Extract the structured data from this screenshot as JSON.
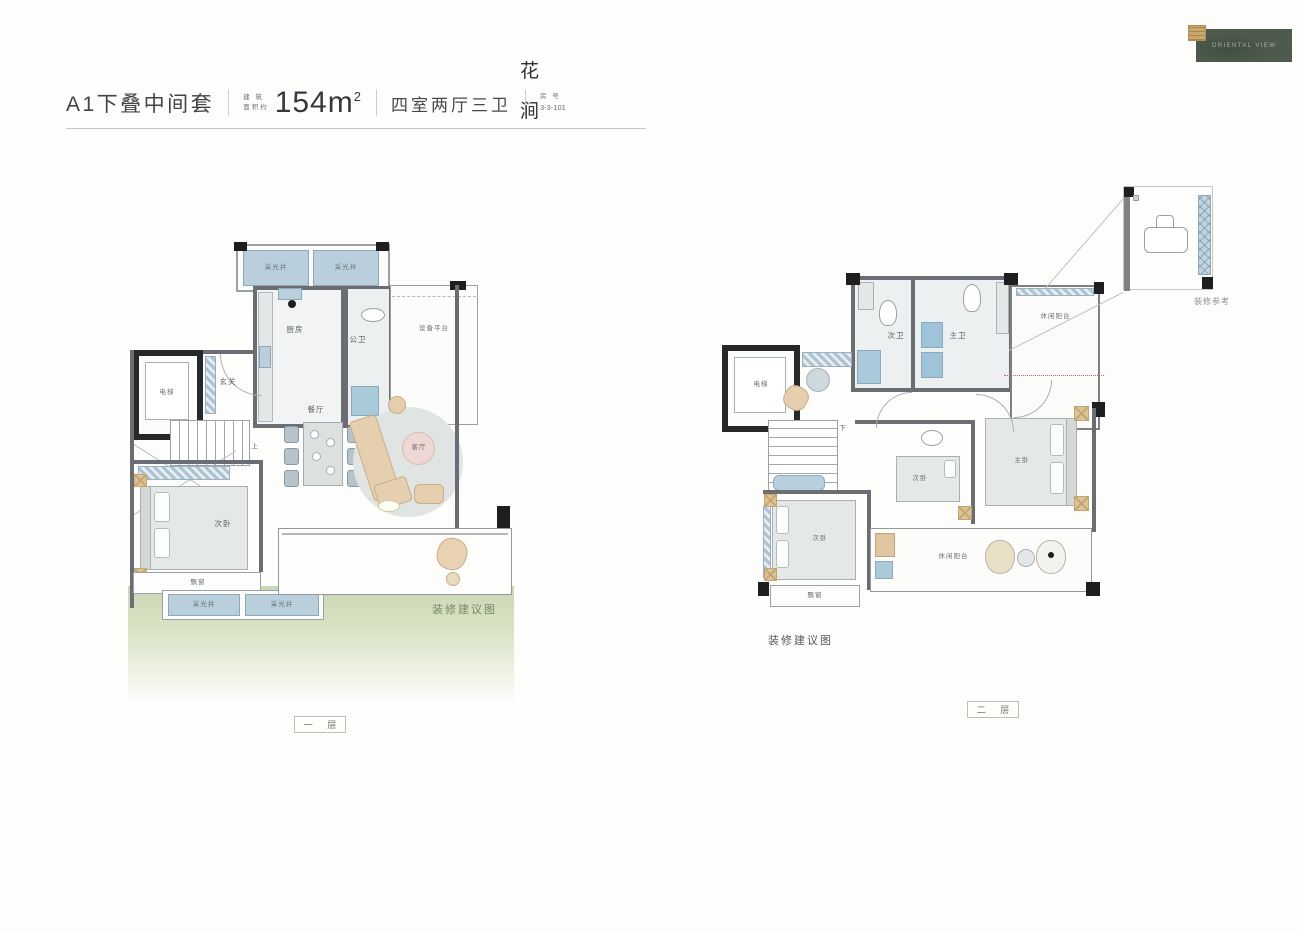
{
  "header": {
    "title": "A1下叠中间套",
    "area_prefix_1": "建 筑",
    "area_prefix_2": "面积约",
    "area_value": "154m",
    "area_sup": "2",
    "layout": "四室两厅三卫",
    "unit_label": "房  号",
    "unit_value": "3-3-101"
  },
  "brand": {
    "name_char_1": "花",
    "name_char_2": "涧",
    "logo_text": "ORIENTAL VIEW"
  },
  "captions": {
    "suggestion": "装修建议图",
    "reference": "装修参考"
  },
  "floor1": {
    "label": "一  层",
    "rooms": {
      "light_well": "采光井",
      "kitchen": "厨房",
      "public_bath": "公卫",
      "equipment_platform": "设备平台",
      "foyer": "玄关",
      "elevator": "电梯",
      "dining": "餐厅",
      "living": "客厅",
      "bedroom_secondary": "次卧",
      "bay_window": "飘窗",
      "stairs_up": "上"
    }
  },
  "floor2": {
    "label": "二  层",
    "rooms": {
      "elevator": "电梯",
      "bath_secondary": "次卫",
      "bath_master": "主卫",
      "leisure_balcony": "休闲阳台",
      "bedroom_secondary": "次卧",
      "bedroom_master": "主卧",
      "bay_window": "飘窗",
      "stairs_down": "下"
    }
  },
  "colors": {
    "wall_gray": "#6a6e72",
    "column_black": "#1d1e20",
    "window_blue": "#b9cfdb",
    "furniture_tan": "#e6cfae",
    "table_pink": "#eed8d4",
    "lawn_green": "#c9d7b3",
    "logo_green": "#4e5b4c",
    "seal_gold": "#caa66a"
  }
}
